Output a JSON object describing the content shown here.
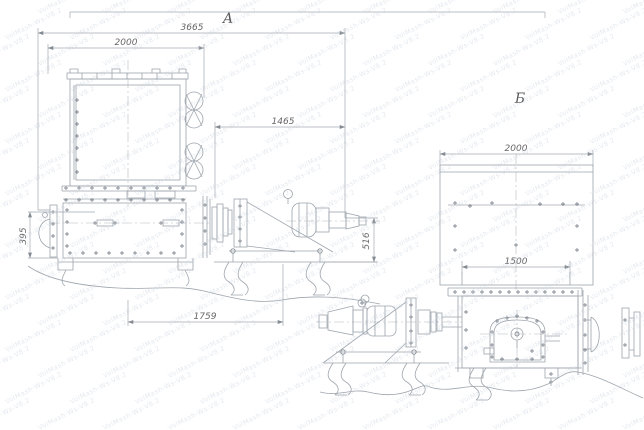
{
  "watermark": {
    "text": "VolMash-Ws-V8.2",
    "color": "#c3cdd9"
  },
  "views": {
    "a": {
      "label": "А",
      "dims": {
        "overall": "3665",
        "top_width": "2000",
        "right_offset": "1465",
        "body_height": "395",
        "base_length": "1759",
        "drive_height": "516"
      }
    },
    "b": {
      "label": "Б",
      "dims": {
        "top_width": "2000",
        "flange_width": "1500"
      }
    }
  }
}
